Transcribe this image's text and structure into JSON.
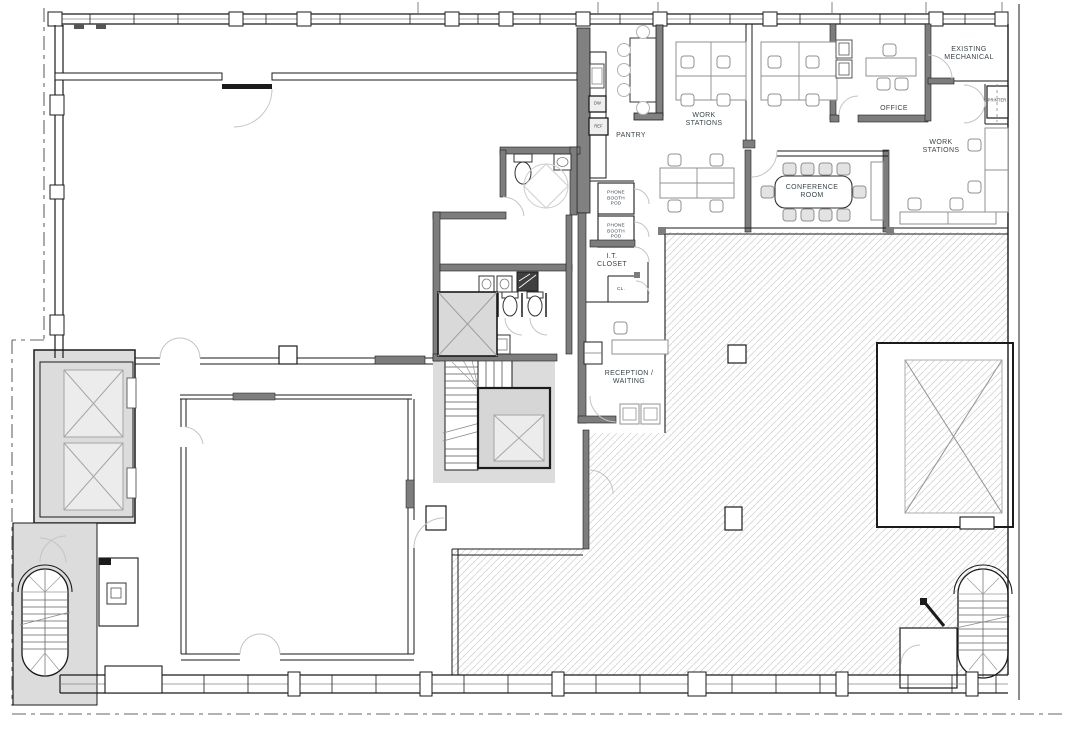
{
  "plan": {
    "rooms": {
      "pantry": {
        "label": "PANTRY"
      },
      "work_stations_top": {
        "label": "WORK\nSTATIONS"
      },
      "work_stations_right": {
        "label": "WORK\nSTATIONS"
      },
      "office": {
        "label": "OFFICE"
      },
      "existing_mechanical": {
        "label": "EXISTING\nMECHANICAL"
      },
      "conference_room": {
        "label": "CONFERENCE\nROOM"
      },
      "phone_booth_pod_1": {
        "label": "PHONE\nBOOTH\nPOD"
      },
      "phone_booth_pod_2": {
        "label": "PHONE\nBOOTH\nPOD"
      },
      "it_closet": {
        "label": "I.T.\nCLOSET"
      },
      "closet": {
        "label": "CL."
      },
      "reception_waiting": {
        "label": "RECEPTION /\nWAITING"
      }
    },
    "equipment": {
      "printer": {
        "label": "PRINTER"
      },
      "dishwasher": {
        "label": "DW"
      },
      "refrigerator": {
        "label": "REF"
      }
    },
    "colors": {
      "wall": "#1b1b1b",
      "wall_fill": "#7d7d7d",
      "core_fill": "#dcdcdc",
      "shaft_fill": "#ececec",
      "shaft_line": "#a5a5a5",
      "hatch_line": "#d4d4d4",
      "furniture_line": "#909090",
      "label_text": "#3a454a",
      "door_arc": "#c4c4c4"
    }
  }
}
